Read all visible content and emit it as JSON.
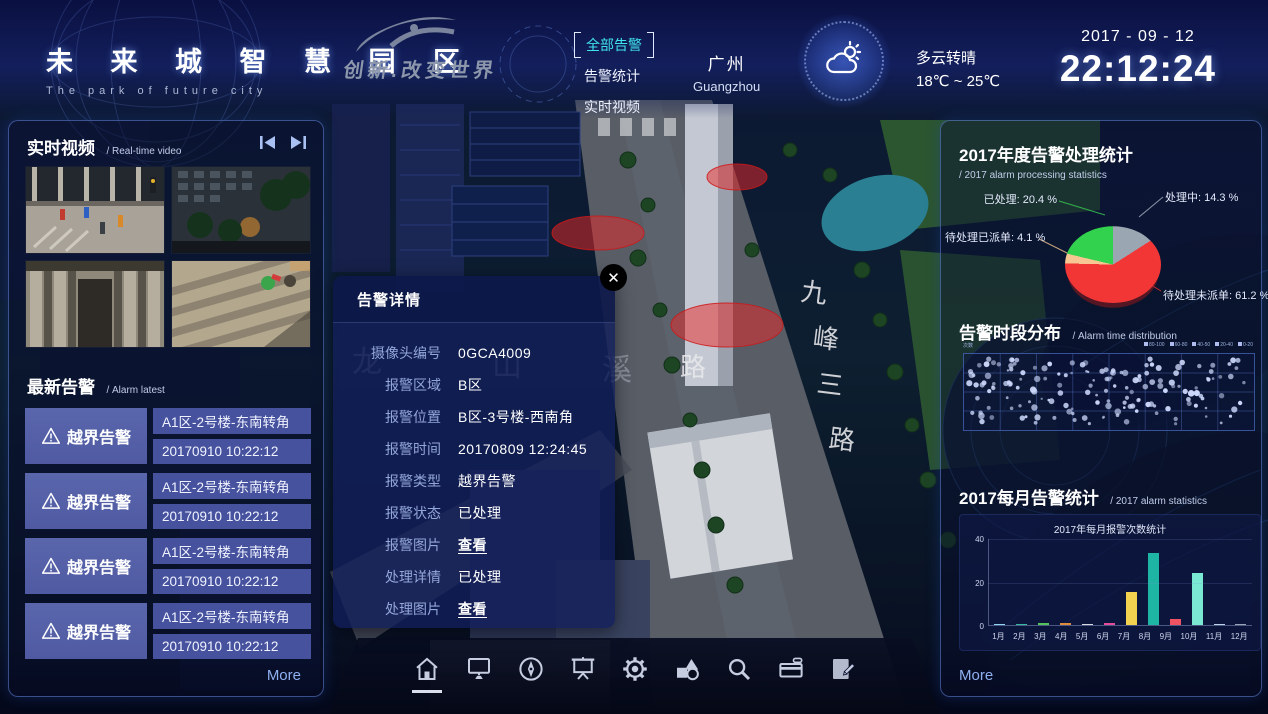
{
  "header": {
    "title": "未 来 城 智 慧 园 区",
    "subtitle": "The park of future city",
    "slogan": "创新.改变世界",
    "nav": [
      {
        "label": "全部告警",
        "active": true
      },
      {
        "label": "告警统计",
        "active": false
      },
      {
        "label": "实时视频",
        "active": false
      }
    ],
    "city_cn": "广州",
    "city_en": "Guangzhou",
    "weather_condition": "多云转晴",
    "weather_temp": "18℃ ~ 25℃",
    "date": "2017 - 09 - 12",
    "time": "22:12:24"
  },
  "left_panel": {
    "video_title": "实时视频",
    "video_subtitle": "/ Real-time video",
    "alarm_title": "最新告警",
    "alarm_subtitle": "/ Alarm latest",
    "alarms": [
      {
        "type": "越界告警",
        "location": "A1区-2号楼-东南转角",
        "time": "20170910 10:22:12"
      },
      {
        "type": "越界告警",
        "location": "A1区-2号楼-东南转角",
        "time": "20170910 10:22:12"
      },
      {
        "type": "越界告警",
        "location": "A1区-2号楼-东南转角",
        "time": "20170910 10:22:12"
      },
      {
        "type": "越界告警",
        "location": "A1区-2号楼-东南转角",
        "time": "20170910 10:22:12"
      }
    ],
    "more": "More"
  },
  "popup": {
    "title": "告警详情",
    "fields": [
      {
        "label": "摄像头编号",
        "value": "0GCA4009",
        "link": false
      },
      {
        "label": "报警区域",
        "value": "B区",
        "link": false
      },
      {
        "label": "报警位置",
        "value": "B区-3号楼-西南角",
        "link": false
      },
      {
        "label": "报警时间",
        "value": "20170809 12:24:45",
        "link": false
      },
      {
        "label": "报警类型",
        "value": "越界告警",
        "link": false
      },
      {
        "label": "报警状态",
        "value": "已处理",
        "link": false
      },
      {
        "label": "报警图片",
        "value": "查看",
        "link": true
      },
      {
        "label": "处理详情",
        "value": "已处理",
        "link": false
      },
      {
        "label": "处理图片",
        "value": "查看",
        "link": true
      }
    ]
  },
  "map": {
    "road_name": [
      "九",
      "峰",
      "三",
      "路"
    ],
    "road_label": "路",
    "water_name": [
      "龙",
      "山",
      "溪"
    ]
  },
  "right_panel": {
    "pie_title": "2017年度告警处理统计",
    "pie_subtitle": "/ 2017 alarm processing statistics",
    "scatter_title": "告警时段分布",
    "scatter_subtitle": "/ Alarm time distribution",
    "scatter_axis_label": "次数",
    "scatter_legend": [
      "80-100",
      "60-80",
      "40-50",
      "20-40",
      "0-20"
    ],
    "bar_title": "2017每月告警统计",
    "bar_subtitle": "/ 2017 alarm statistics",
    "more": "More"
  },
  "toolbar": {
    "icons": [
      "home",
      "monitor",
      "compass",
      "projection-screen",
      "gear",
      "shapes",
      "search",
      "card-reader",
      "edit"
    ],
    "active": "home"
  },
  "chart_data": [
    {
      "type": "pie",
      "title": "2017年度告警处理统计",
      "unit": "%",
      "slices": [
        {
          "label": "处理中",
          "value": 14.3,
          "color": "#9aa7b2"
        },
        {
          "label": "待处理未派单",
          "value": 61.2,
          "color": "#f23636"
        },
        {
          "label": "待处理已派单",
          "value": 4.1,
          "color": "#f7c692"
        },
        {
          "label": "已处理",
          "value": 20.4,
          "color": "#32d24e"
        }
      ]
    },
    {
      "type": "scatter",
      "title": "告警时段分布",
      "point_count": 165,
      "point_color": "#ccd8fb",
      "x_range": [
        0,
        24
      ],
      "grid": true,
      "seed": 12
    },
    {
      "type": "bar",
      "title": "2017年每月报警次数统计",
      "categories": [
        "1月",
        "2月",
        "3月",
        "4月",
        "5月",
        "6月",
        "7月",
        "8月",
        "9月",
        "10月",
        "11月",
        "12月"
      ],
      "values": [
        0.5,
        0.6,
        0.8,
        0.8,
        0.7,
        0.8,
        15,
        33,
        3,
        24,
        0.4,
        0.4
      ],
      "colors": [
        "#8fd4f0",
        "#35b8a0",
        "#52c45a",
        "#e08a3c",
        "#d8dce2",
        "#e84a9a",
        "#f2d24e",
        "#1fb5a5",
        "#f05462",
        "#7be8d4",
        "#bcd2e8",
        "#9aa4b4"
      ],
      "ylim": [
        0,
        40
      ],
      "yticks": [
        0,
        20,
        40
      ]
    }
  ]
}
